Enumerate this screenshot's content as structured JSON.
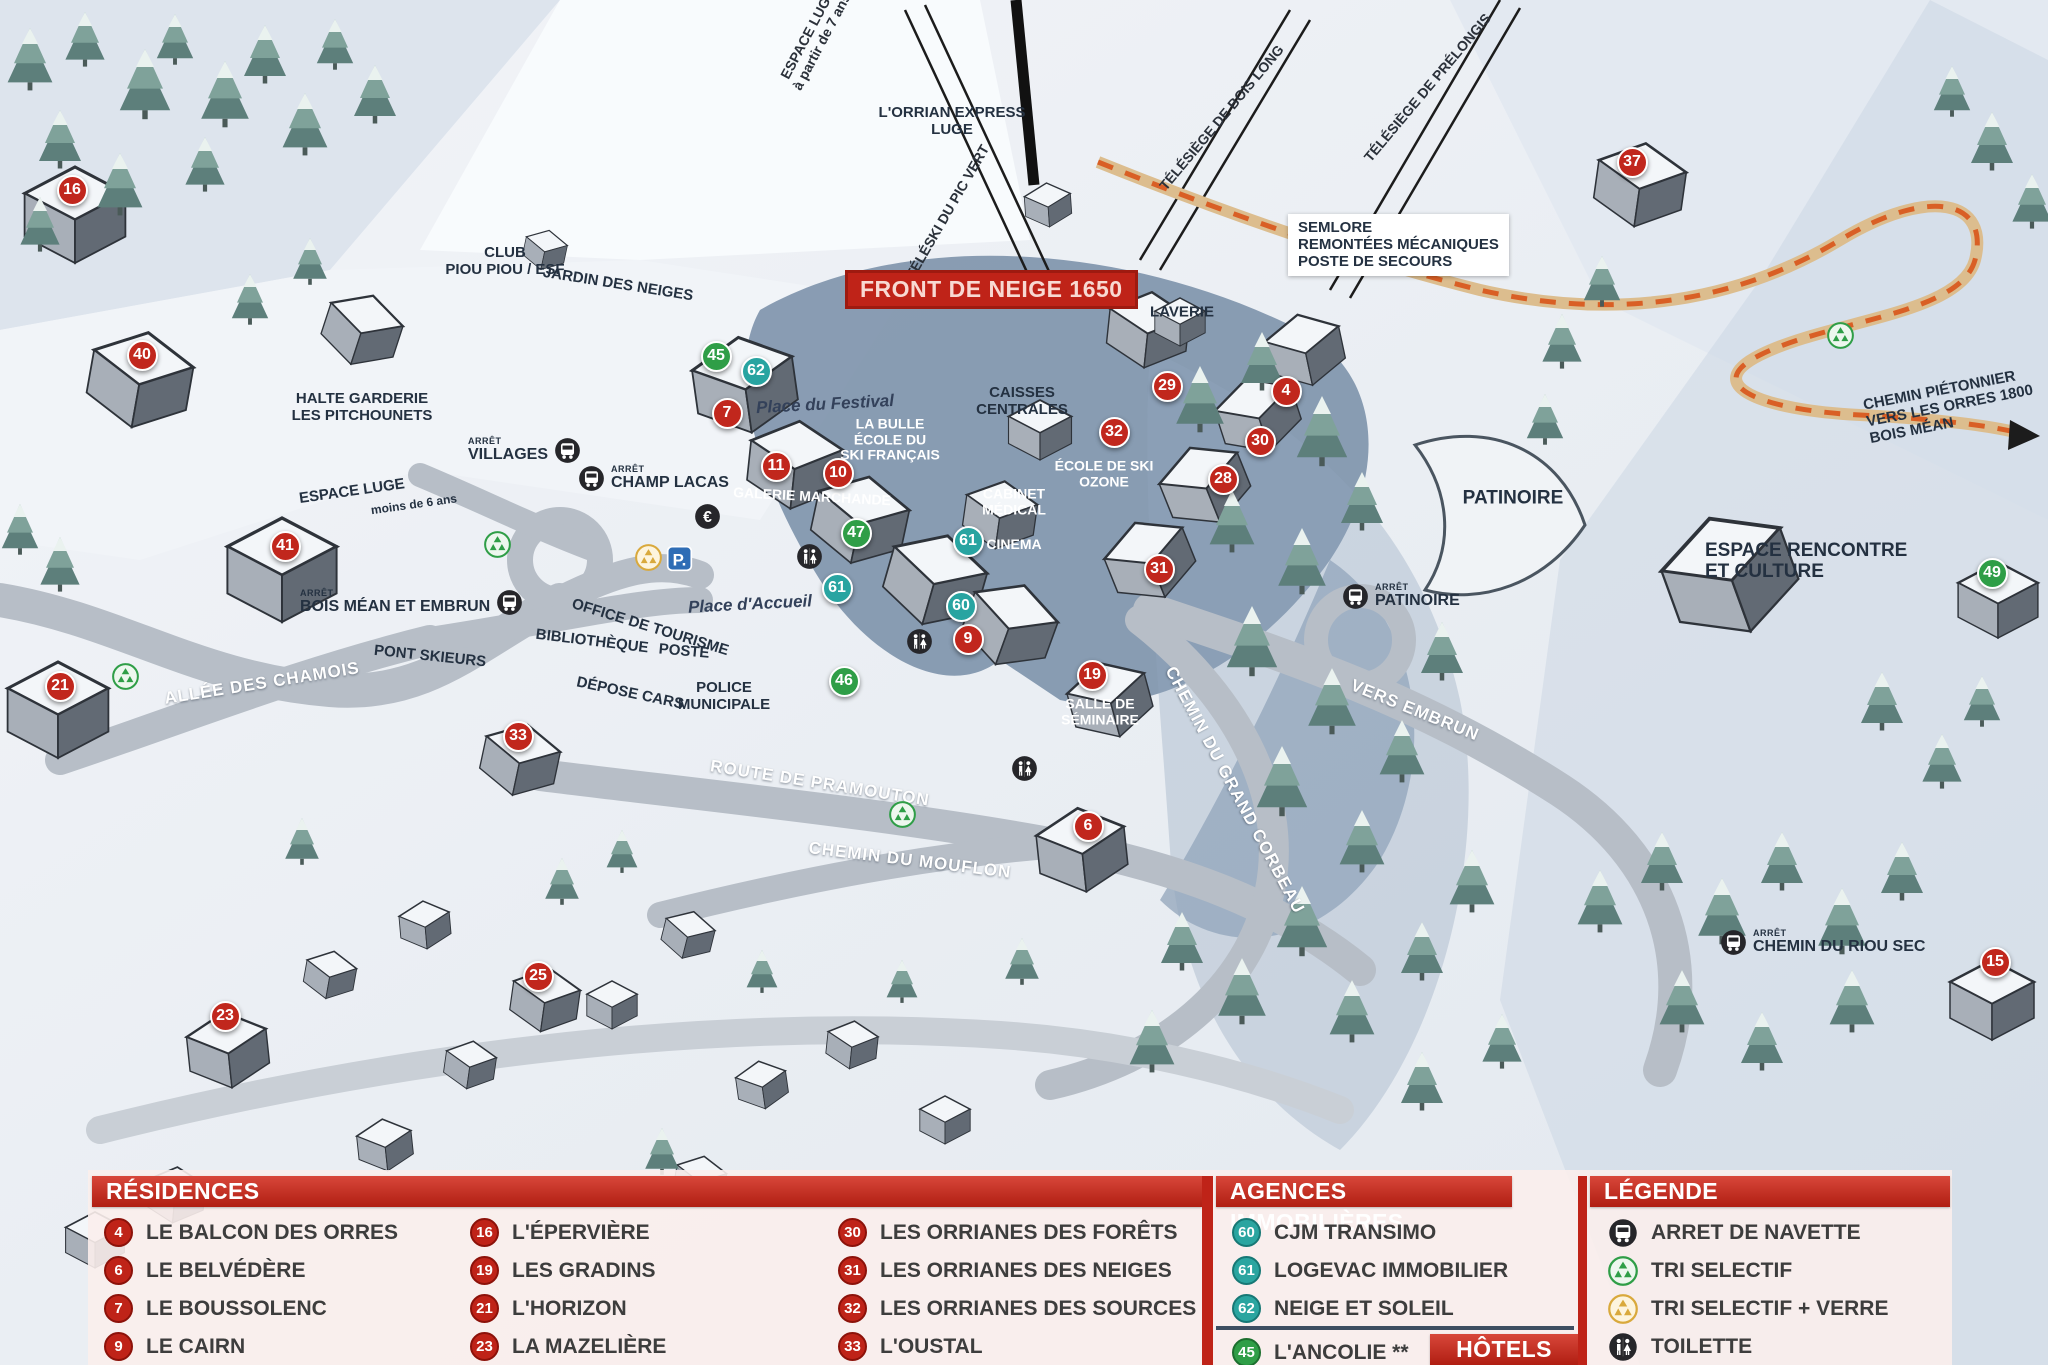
{
  "map": {
    "banner": "FRONT DE NEIGE 1650",
    "bus_prefix": "ARRÊT",
    "labels": [
      {
        "lines": [
          "ESPACE LUGE",
          "à partir de 7 ans"
        ],
        "x": 815,
        "y": 38,
        "rot": -62,
        "cls": "lift"
      },
      {
        "lines": [
          "TÉLÉSKI DU PIC VERT"
        ],
        "x": 948,
        "y": 212,
        "rot": -60,
        "cls": "lift"
      },
      {
        "lines": [
          "L'ORRIAN EXPRESS",
          "LUGE"
        ],
        "x": 952,
        "y": 122,
        "rot": 0,
        "cls": "poi-sm"
      },
      {
        "lines": [
          "TÉLÉSIÈGE DE BOIS LONG"
        ],
        "x": 1222,
        "y": 118,
        "rot": -50,
        "cls": "lift"
      },
      {
        "lines": [
          "TÉLÉSIÈGE DE PRÉLONGIS"
        ],
        "x": 1428,
        "y": 88,
        "rot": -50,
        "cls": "lift"
      },
      {
        "lines": [
          "CLUB",
          "PIOU PIOU / ESF"
        ],
        "x": 505,
        "y": 262,
        "rot": 0,
        "cls": "poi-sm"
      },
      {
        "lines": [
          "JARDIN DES NEIGES"
        ],
        "x": 618,
        "y": 285,
        "rot": 9,
        "cls": "poi-sm"
      },
      {
        "lines": [
          "HALTE GARDERIE",
          "LES PITCHOUNETS"
        ],
        "x": 362,
        "y": 408,
        "rot": 0,
        "cls": "poi-sm"
      },
      {
        "lines": [
          "ESPACE LUGE"
        ],
        "x": 352,
        "y": 492,
        "rot": -8,
        "cls": "poi-sm"
      },
      {
        "lines": [
          "moins de 6 ans"
        ],
        "x": 414,
        "y": 505,
        "rot": -8,
        "cls": "tiny"
      },
      {
        "lines": [
          "Place du Festival"
        ],
        "x": 825,
        "y": 404,
        "rot": -3,
        "cls": "place"
      },
      {
        "lines": [
          "LA BULLE",
          "ÉCOLE DU",
          "SKI FRANÇAIS"
        ],
        "x": 890,
        "y": 440,
        "rot": 0,
        "cls": "poi-white-sm"
      },
      {
        "lines": [
          "GALERIE MARCHANDE"
        ],
        "x": 812,
        "y": 497,
        "rot": 3,
        "cls": "poi-white-sm"
      },
      {
        "lines": [
          "CAISSES",
          "CENTRALES"
        ],
        "x": 1022,
        "y": 402,
        "rot": 0,
        "cls": "poi-sm"
      },
      {
        "lines": [
          "LAVERIE"
        ],
        "x": 1182,
        "y": 313,
        "rot": 0,
        "cls": "poi-sm"
      },
      {
        "lines": [
          "ÉCOLE DE SKI",
          "OZONE"
        ],
        "x": 1104,
        "y": 474,
        "rot": 0,
        "cls": "poi-white-sm"
      },
      {
        "lines": [
          "CABINET",
          "MÉDICAL"
        ],
        "x": 1014,
        "y": 502,
        "rot": 0,
        "cls": "poi-white-sm"
      },
      {
        "lines": [
          "CINEMA"
        ],
        "x": 1014,
        "y": 545,
        "rot": 0,
        "cls": "poi-white-sm"
      },
      {
        "lines": [
          "SEMLORE",
          "REMONTÉES MÉCANIQUES",
          "POSTE DE SECOURS"
        ],
        "x": 1288,
        "y": 214,
        "rot": 0,
        "cls": "box",
        "align": "left"
      },
      {
        "lines": [
          "PATINOIRE"
        ],
        "x": 1513,
        "y": 498,
        "rot": 0,
        "cls": "poi"
      },
      {
        "lines": [
          "ESPACE RENCONTRE",
          "ET CULTURE"
        ],
        "x": 1705,
        "y": 540,
        "rot": 0,
        "cls": "poi",
        "align": "left"
      },
      {
        "lines": [
          "CHEMIN PIÉTONNIER",
          "VERS LES ORRES 1800",
          "BOIS MÉAN"
        ],
        "x": 1862,
        "y": 398,
        "rot": -11,
        "cls": "poi-sm",
        "align": "left"
      },
      {
        "lines": [
          "OFFICE DE TOURISME"
        ],
        "x": 650,
        "y": 628,
        "rot": 17,
        "cls": "poi-sm"
      },
      {
        "lines": [
          "BIBLIOTHÈQUE"
        ],
        "x": 592,
        "y": 642,
        "rot": 7,
        "cls": "poi-sm"
      },
      {
        "lines": [
          "POSTE"
        ],
        "x": 684,
        "y": 652,
        "rot": 5,
        "cls": "poi-sm"
      },
      {
        "lines": [
          "DÉPOSE CARS"
        ],
        "x": 630,
        "y": 694,
        "rot": 12,
        "cls": "poi-sm"
      },
      {
        "lines": [
          "POLICE",
          "MUNICIPALE"
        ],
        "x": 724,
        "y": 697,
        "rot": 0,
        "cls": "poi-sm"
      },
      {
        "lines": [
          "PONT SKIEURS"
        ],
        "x": 430,
        "y": 657,
        "rot": 6,
        "cls": "poi-sm"
      },
      {
        "lines": [
          "ALLÉE DES CHAMOIS"
        ],
        "x": 262,
        "y": 683,
        "rot": -9,
        "cls": "road"
      },
      {
        "lines": [
          "Place d'Accueil"
        ],
        "x": 750,
        "y": 604,
        "rot": -3,
        "cls": "place"
      },
      {
        "lines": [
          "ROUTE DE PRAMOUTON"
        ],
        "x": 820,
        "y": 783,
        "rot": 9,
        "cls": "road"
      },
      {
        "lines": [
          "CHEMIN DU MOUFLON"
        ],
        "x": 910,
        "y": 860,
        "rot": 7,
        "cls": "road"
      },
      {
        "lines": [
          "CHEMIN DU GRAND CORBEAU"
        ],
        "x": 1235,
        "y": 790,
        "rot": 62,
        "cls": "road"
      },
      {
        "lines": [
          "VERS EMBRUN"
        ],
        "x": 1415,
        "y": 710,
        "rot": 22,
        "cls": "road"
      },
      {
        "lines": [
          "SALLE DE",
          "SÉMINAIRE"
        ],
        "x": 1100,
        "y": 712,
        "rot": 0,
        "cls": "poi-white-sm"
      }
    ],
    "bus_stops": [
      {
        "label": "VILLAGES",
        "x": 468,
        "y": 450,
        "order": "ti"
      },
      {
        "label": "CHAMP LACAS",
        "x": 578,
        "y": 478,
        "order": "it"
      },
      {
        "label": "BOIS MÉAN ET EMBRUN",
        "x": 300,
        "y": 602,
        "order": "ti"
      },
      {
        "label": "PATINOIRE",
        "x": 1342,
        "y": 596,
        "order": "it"
      },
      {
        "label": "CHEMIN DU RIOU SEC",
        "x": 1720,
        "y": 942,
        "order": "it"
      }
    ],
    "markers": [
      {
        "n": "16",
        "x": 72,
        "y": 190,
        "c": "res"
      },
      {
        "n": "40",
        "x": 142,
        "y": 355,
        "c": "res"
      },
      {
        "n": "41",
        "x": 285,
        "y": 546,
        "c": "res"
      },
      {
        "n": "21",
        "x": 60,
        "y": 686,
        "c": "res"
      },
      {
        "n": "33",
        "x": 518,
        "y": 736,
        "c": "res"
      },
      {
        "n": "23",
        "x": 225,
        "y": 1016,
        "c": "res"
      },
      {
        "n": "25",
        "x": 538,
        "y": 976,
        "c": "res"
      },
      {
        "n": "7",
        "x": 727,
        "y": 413,
        "c": "res"
      },
      {
        "n": "11",
        "x": 776,
        "y": 466,
        "c": "res"
      },
      {
        "n": "10",
        "x": 838,
        "y": 473,
        "c": "res"
      },
      {
        "n": "9",
        "x": 968,
        "y": 639,
        "c": "res"
      },
      {
        "n": "29",
        "x": 1167,
        "y": 386,
        "c": "res"
      },
      {
        "n": "32",
        "x": 1114,
        "y": 432,
        "c": "res"
      },
      {
        "n": "4",
        "x": 1286,
        "y": 391,
        "c": "res"
      },
      {
        "n": "30",
        "x": 1260,
        "y": 441,
        "c": "res"
      },
      {
        "n": "28",
        "x": 1223,
        "y": 479,
        "c": "res"
      },
      {
        "n": "31",
        "x": 1159,
        "y": 569,
        "c": "res"
      },
      {
        "n": "19",
        "x": 1092,
        "y": 675,
        "c": "res"
      },
      {
        "n": "6",
        "x": 1088,
        "y": 826,
        "c": "res"
      },
      {
        "n": "37",
        "x": 1632,
        "y": 162,
        "c": "res"
      },
      {
        "n": "15",
        "x": 1995,
        "y": 962,
        "c": "res"
      },
      {
        "n": "62",
        "x": 756,
        "y": 371,
        "c": "ag"
      },
      {
        "n": "61",
        "x": 968,
        "y": 541,
        "c": "ag"
      },
      {
        "n": "61",
        "x": 837,
        "y": 588,
        "c": "ag"
      },
      {
        "n": "60",
        "x": 961,
        "y": 606,
        "c": "ag"
      },
      {
        "n": "45",
        "x": 716,
        "y": 356,
        "c": "grn"
      },
      {
        "n": "47",
        "x": 856,
        "y": 533,
        "c": "grn"
      },
      {
        "n": "46",
        "x": 844,
        "y": 681,
        "c": "grn"
      },
      {
        "n": "49",
        "x": 1992,
        "y": 573,
        "c": "grn"
      }
    ],
    "icons": [
      {
        "t": "euro",
        "x": 707,
        "y": 516
      },
      {
        "t": "parking",
        "x": 679,
        "y": 558
      },
      {
        "t": "recycle-yellow",
        "x": 648,
        "y": 557
      },
      {
        "t": "recycle-green",
        "x": 497,
        "y": 544
      },
      {
        "t": "recycle-green",
        "x": 125,
        "y": 676
      },
      {
        "t": "recycle-green",
        "x": 902,
        "y": 814
      },
      {
        "t": "recycle-green",
        "x": 1840,
        "y": 335
      },
      {
        "t": "toilet",
        "x": 809,
        "y": 556
      },
      {
        "t": "toilet",
        "x": 919,
        "y": 641
      },
      {
        "t": "toilet",
        "x": 1024,
        "y": 768
      }
    ]
  },
  "panel": {
    "residences": {
      "title": "RÉSIDENCES",
      "items": [
        {
          "n": "4",
          "label": "LE BALCON DES ORRES"
        },
        {
          "n": "6",
          "label": "LE BELVÉDÈRE"
        },
        {
          "n": "7",
          "label": "LE BOUSSOLENC"
        },
        {
          "n": "9",
          "label": "LE CAIRN"
        },
        {
          "n": "16",
          "label": "L'ÉPERVIÈRE"
        },
        {
          "n": "19",
          "label": "LES GRADINS"
        },
        {
          "n": "21",
          "label": "L'HORIZON"
        },
        {
          "n": "23",
          "label": "LA MAZELIÈRE"
        },
        {
          "n": "30",
          "label": "LES ORRIANES DES FORÊTS"
        },
        {
          "n": "31",
          "label": "LES ORRIANES DES NEIGES"
        },
        {
          "n": "32",
          "label": "LES ORRIANES DES SOURCES"
        },
        {
          "n": "33",
          "label": "L'OUSTAL"
        }
      ]
    },
    "agences": {
      "title": "AGENCES IMMOBILIÈRES",
      "items": [
        {
          "n": "60",
          "label": "CJM TRANSIMO"
        },
        {
          "n": "61",
          "label": "LOGEVAC IMMOBILIER"
        },
        {
          "n": "62",
          "label": "NEIGE ET SOLEIL"
        }
      ]
    },
    "hotels": {
      "title": "HÔTELS",
      "items": [
        {
          "n": "45",
          "label": "L'ANCOLIE **"
        }
      ]
    },
    "legende": {
      "title": "LÉGENDE",
      "items": [
        {
          "icon": "bus",
          "label": "ARRET DE NAVETTE"
        },
        {
          "icon": "recycle-green",
          "label": "TRI SELECTIF"
        },
        {
          "icon": "recycle-yellow",
          "label": "TRI SELECTIF + VERRE"
        },
        {
          "icon": "toilet",
          "label": "TOILETTE"
        }
      ]
    }
  },
  "colors": {
    "header_red": "#b01e12",
    "marker_residence": "#c1271d",
    "marker_agency": "#28a4a1",
    "marker_hotel_green": "#2f9e47",
    "panel_bg": "#fbeeec",
    "road_gray": "#b7bec7",
    "pedestrian_path_orange": "#d95f25",
    "shadow_blue": "#7d92ab"
  }
}
